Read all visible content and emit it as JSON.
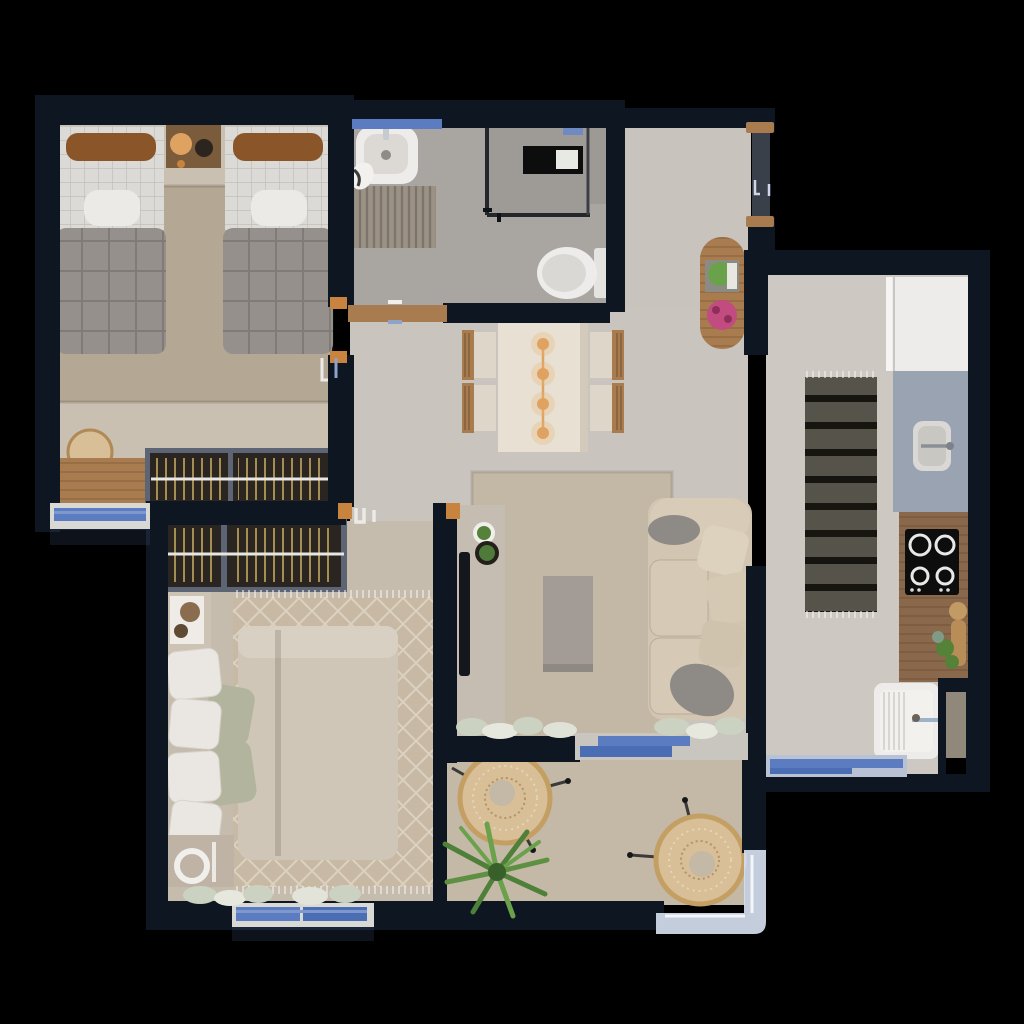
{
  "scene": {
    "kind": "apartment-floor-plan-3d-render",
    "view": "top-down",
    "background": "#000000"
  },
  "colors": {
    "wall": "#0e1621",
    "wall_inner": "#131c28",
    "floor_bedroom1": "#c9c0b2",
    "floor_master": "#c6bcae",
    "floor_bath": "#a9a5a1",
    "floor_shower": "#9e9a96",
    "floor_living": "#c9c4be",
    "floor_hall": "#c8c3bd",
    "floor_kitchen": "#cdc8c1",
    "floor_niche": "#8f887b",
    "floor_balcony": "#c4b9a7",
    "rug_bedroom1": "#b4a895",
    "rug_master": "#c7b9a3",
    "rug_living": "#c3b8a5",
    "rug_kitchen": "#55534a",
    "bed_duvet_gray": "#95908b",
    "bed_sheet": "#dcdad6",
    "pillow_brown": "#8a5629",
    "bed_master": "#cfc6b8",
    "pillow_white": "#eae7e2",
    "pillow_sage": "#b2b49e",
    "sofa": "#d2c6b2",
    "sofa_cushion": "#d8ccb8",
    "pillow_gray": "#8e8b86",
    "table_cream": "#e8e0d3",
    "chair_seat": "#ded6c8",
    "wood": "#a87c4e",
    "wood_dark": "#7a5c3c",
    "wood_counter": "#8a684c",
    "accent_orange": "#e0a261",
    "door_frame_wood": "#c8833f",
    "window_glass": "#5b7cc0",
    "window_glass_dark": "#4a6db4",
    "window_frame": "#d8d8d4",
    "railing_glass": "#d4deee",
    "counter_gray": "#9aa3b1",
    "appliance_white": "#edecea",
    "wardrobe_frame": "#5d6575",
    "wardrobe_dark": "#2a2520",
    "tv_black": "#14181c",
    "console_gray": "#c6bdb2",
    "coffee_table": "#a39c96",
    "plant_green": "#558238",
    "plant_green_light": "#6aa14b",
    "flower_pink": "#c24b80",
    "curtain_sage": "#ccd2c2",
    "mat_gray": "#9b9286",
    "stove_black": "#0d0d0d",
    "rattan": "#d8bf97",
    "rattan_dark": "#c49f63",
    "vanity_white": "#efece7",
    "lamp_white": "#f1efec"
  },
  "rooms": [
    {
      "id": "bedroom-1",
      "name": "twin bedroom",
      "furniture": [
        "twin-bed-left",
        "twin-bed-right",
        "nightstand",
        "table-lamp",
        "area-rug",
        "wardrobe",
        "desk",
        "desk-chair",
        "window",
        "door"
      ]
    },
    {
      "id": "bathroom",
      "name": "bathroom",
      "furniture": [
        "washbasin",
        "towel",
        "bath-mat",
        "shower-enclosure",
        "shower-niche",
        "toilet",
        "door-threshold",
        "window"
      ]
    },
    {
      "id": "entry-hall",
      "name": "entry hall",
      "furniture": [
        "oval-console-table",
        "boxed-plant",
        "pink-flowers",
        "entry-door"
      ]
    },
    {
      "id": "living-dining",
      "name": "living and dining room",
      "furniture": [
        "dining-table",
        "dining-chair-1",
        "dining-chair-2",
        "dining-chair-3",
        "dining-chair-4",
        "pendant-light",
        "tv-console",
        "tv",
        "potted-plant",
        "plant-stool",
        "area-rug",
        "coffee-table",
        "sofa",
        "sofa-pillows",
        "curtain-planter",
        "sliding-door"
      ]
    },
    {
      "id": "master-bedroom",
      "name": "master bedroom",
      "furniture": [
        "wardrobe",
        "vanity-desk",
        "double-bed",
        "pillows",
        "area-rug",
        "nightstand",
        "bedside-lamp",
        "curtains",
        "window",
        "door"
      ]
    },
    {
      "id": "kitchen-laundry",
      "name": "kitchen and laundry",
      "furniture": [
        "refrigerator",
        "sink-countertop",
        "kitchen-sink",
        "runner-rug",
        "wood-countertop",
        "cooktop",
        "cutting-board",
        "herbs",
        "laundry-sink",
        "service-niche",
        "window"
      ]
    },
    {
      "id": "balcony",
      "name": "balcony",
      "furniture": [
        "acapulco-chair-1",
        "acapulco-chair-2",
        "palm-plant",
        "glass-railing"
      ]
    }
  ]
}
